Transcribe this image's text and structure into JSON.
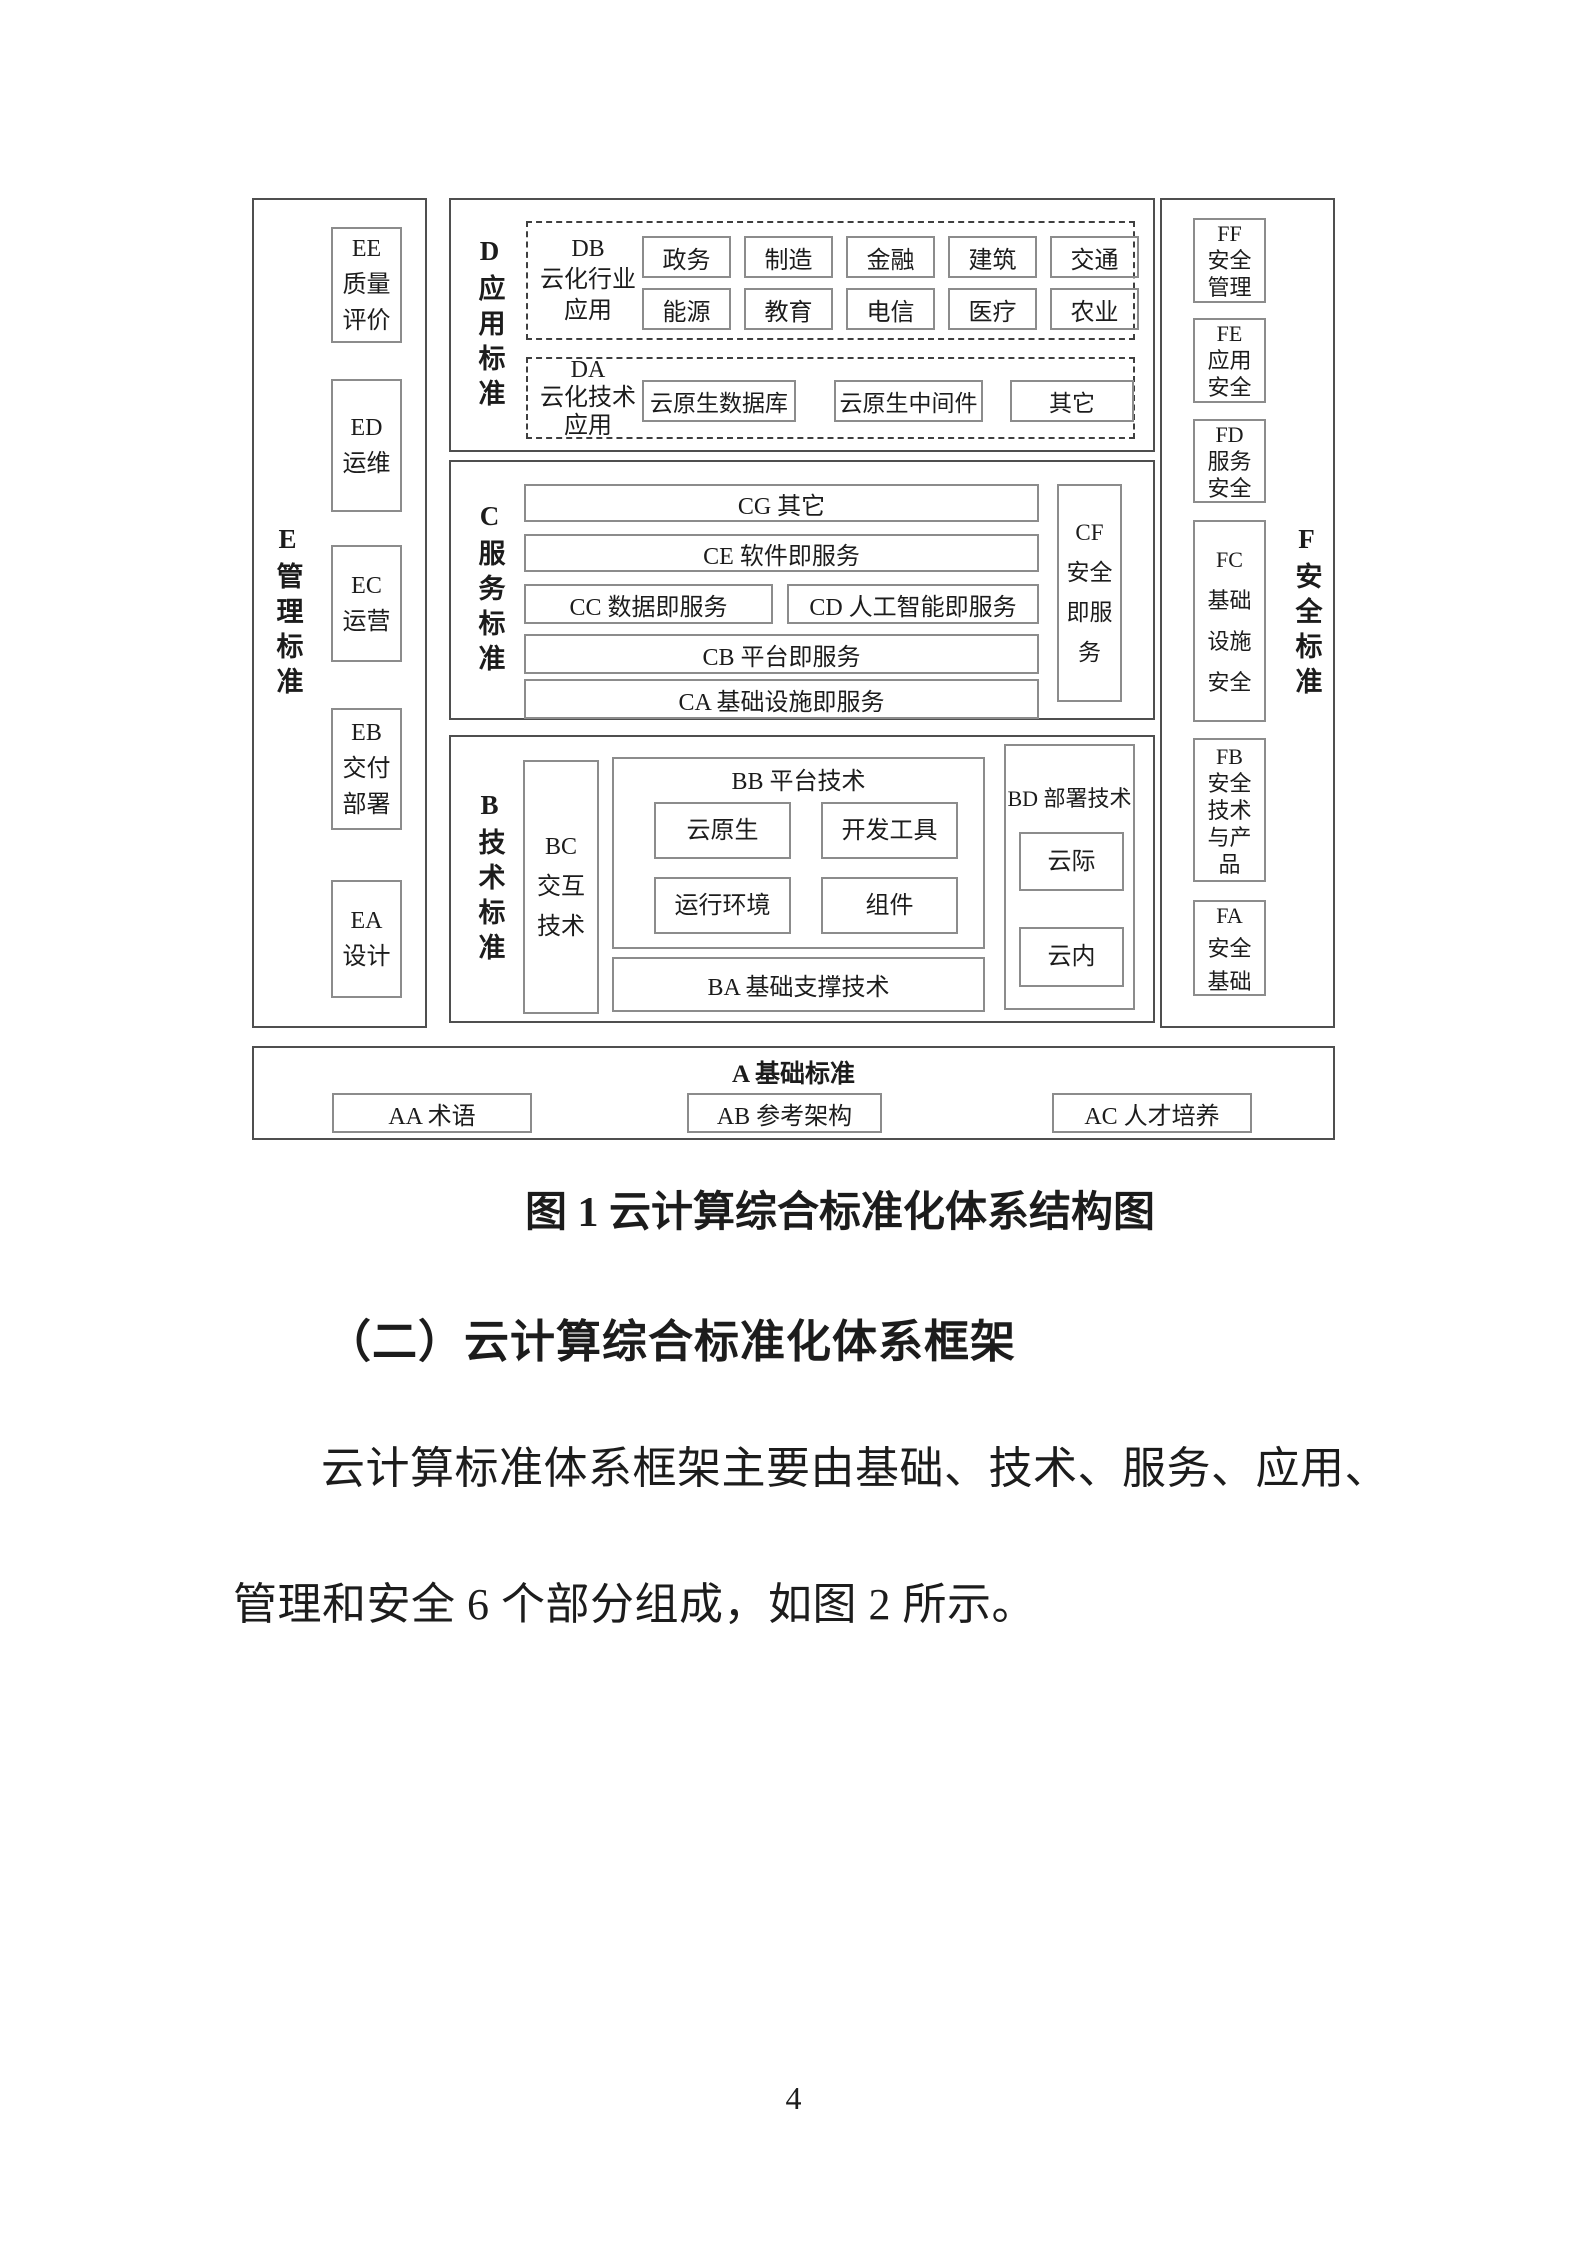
{
  "figure": {
    "e": {
      "label": "E管理标准",
      "boxes": [
        [
          "EE",
          "质量",
          "评价"
        ],
        [
          "ED",
          "运维"
        ],
        [
          "EC",
          "运营"
        ],
        [
          "EB",
          "交付",
          "部署"
        ],
        [
          "EA",
          "设计"
        ]
      ]
    },
    "d": {
      "label": "D应用标准",
      "db": {
        "lines": [
          "DB",
          "云化行业",
          "应用"
        ],
        "row1": [
          "政务",
          "制造",
          "金融",
          "建筑",
          "交通"
        ],
        "row2": [
          "能源",
          "教育",
          "电信",
          "医疗",
          "农业"
        ]
      },
      "da": {
        "lines": [
          "DA",
          "云化技术",
          "应用"
        ],
        "boxes": [
          "云原生数据库",
          "云原生中间件",
          "其它"
        ]
      }
    },
    "c": {
      "label": "C服务标准",
      "row_cg": "CG 其它",
      "row_ce": "CE 软件即服务",
      "row_cc": "CC 数据即服务",
      "row_cd": "CD 人工智能即服务",
      "row_cb": "CB 平台即服务",
      "row_ca": "CA 基础设施即服务",
      "cf": [
        "CF",
        "安全",
        "即服",
        "务"
      ]
    },
    "b": {
      "label": "B技术标准",
      "bc": [
        "BC",
        "交互",
        "技术"
      ],
      "bb_title": "BB 平台技术",
      "bb_boxes": [
        "云原生",
        "开发工具",
        "运行环境",
        "组件"
      ],
      "ba": "BA 基础支撑技术",
      "bd_title": "BD 部署技术",
      "bd_boxes": [
        "云际",
        "云内"
      ]
    },
    "f": {
      "label": "F安全标准",
      "boxes": [
        [
          "FF",
          "安全",
          "管理"
        ],
        [
          "FE",
          "应用",
          "安全"
        ],
        [
          "FD",
          "服务",
          "安全"
        ],
        [
          "FC",
          "基础",
          "设施",
          "安全"
        ],
        [
          "FB",
          "安全",
          "技术",
          "与产",
          "品"
        ],
        [
          "FA",
          "安全",
          "基础"
        ]
      ]
    },
    "a": {
      "title": "A 基础标准",
      "boxes": [
        "AA 术语",
        "AB 参考架构",
        "AC 人才培养"
      ]
    }
  },
  "text": {
    "caption": "图 1 云计算综合标准化体系结构图",
    "heading": "（二）云计算综合标准化体系框架",
    "body_line1": "云计算标准体系框架主要由基础、技术、服务、应用、",
    "body_line2": "管理和安全 6 个部分组成，如图 2 所示。",
    "page_number": "4"
  }
}
